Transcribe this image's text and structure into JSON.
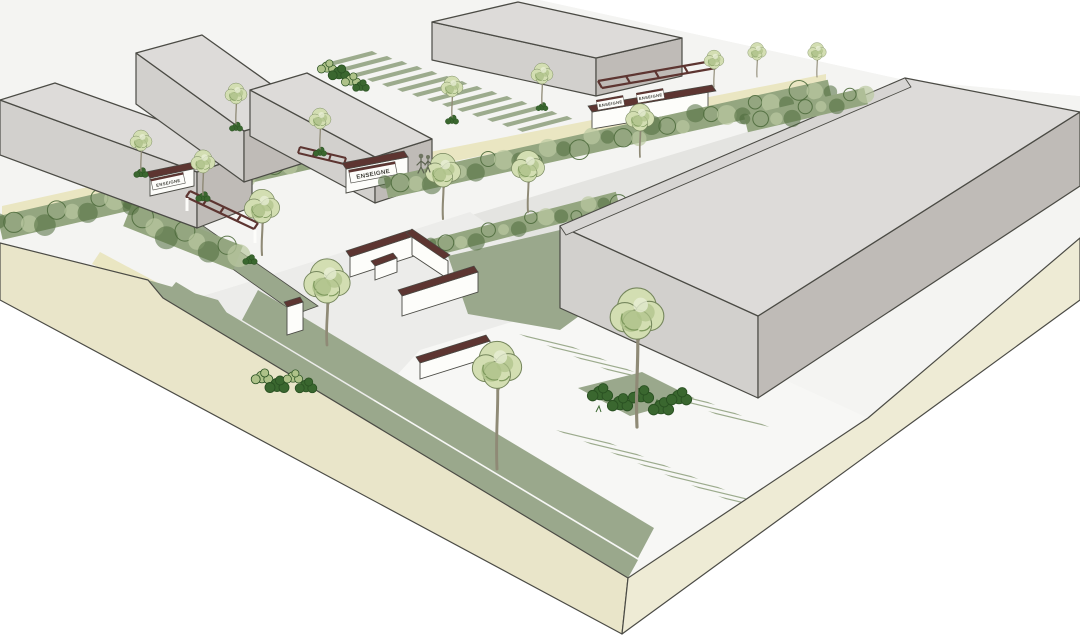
{
  "signs": [
    {
      "label": "ENSEIGNE"
    },
    {
      "label": "ENSEIGNE"
    },
    {
      "label": "ENSEIGNE"
    },
    {
      "label": "ENSEIGNE"
    }
  ],
  "palette": {
    "paper": "#ffffff",
    "base": "#f4f4f2",
    "road": "#e4e4e1",
    "plaza": "#ececea",
    "lot": "#f7f7f5",
    "path": "#eae6c2",
    "lawn": "#9aa88c",
    "stripe": "#9cab8d",
    "beige": "#e9e5c9",
    "beige2": "#eeebd5",
    "roof": "#dddbd9",
    "faceL": "#d2d0cd",
    "faceD": "#bfbbb7",
    "parapet": "#d7d5d3",
    "hedge": "#94a680",
    "hedgeDark": "#4e6b3c",
    "hedgeLight": "#bac9a1",
    "canopy": "#d3deb2",
    "canopyMid": "#aec289",
    "canopyDark": "#7f9a5e",
    "shrub": "#3a672f",
    "trunk": "#8f8a76",
    "coping": "#5d3531",
    "wallWhite": "#fdfdfa",
    "outline": "#4b4b45",
    "signText": "#3c3c35"
  }
}
